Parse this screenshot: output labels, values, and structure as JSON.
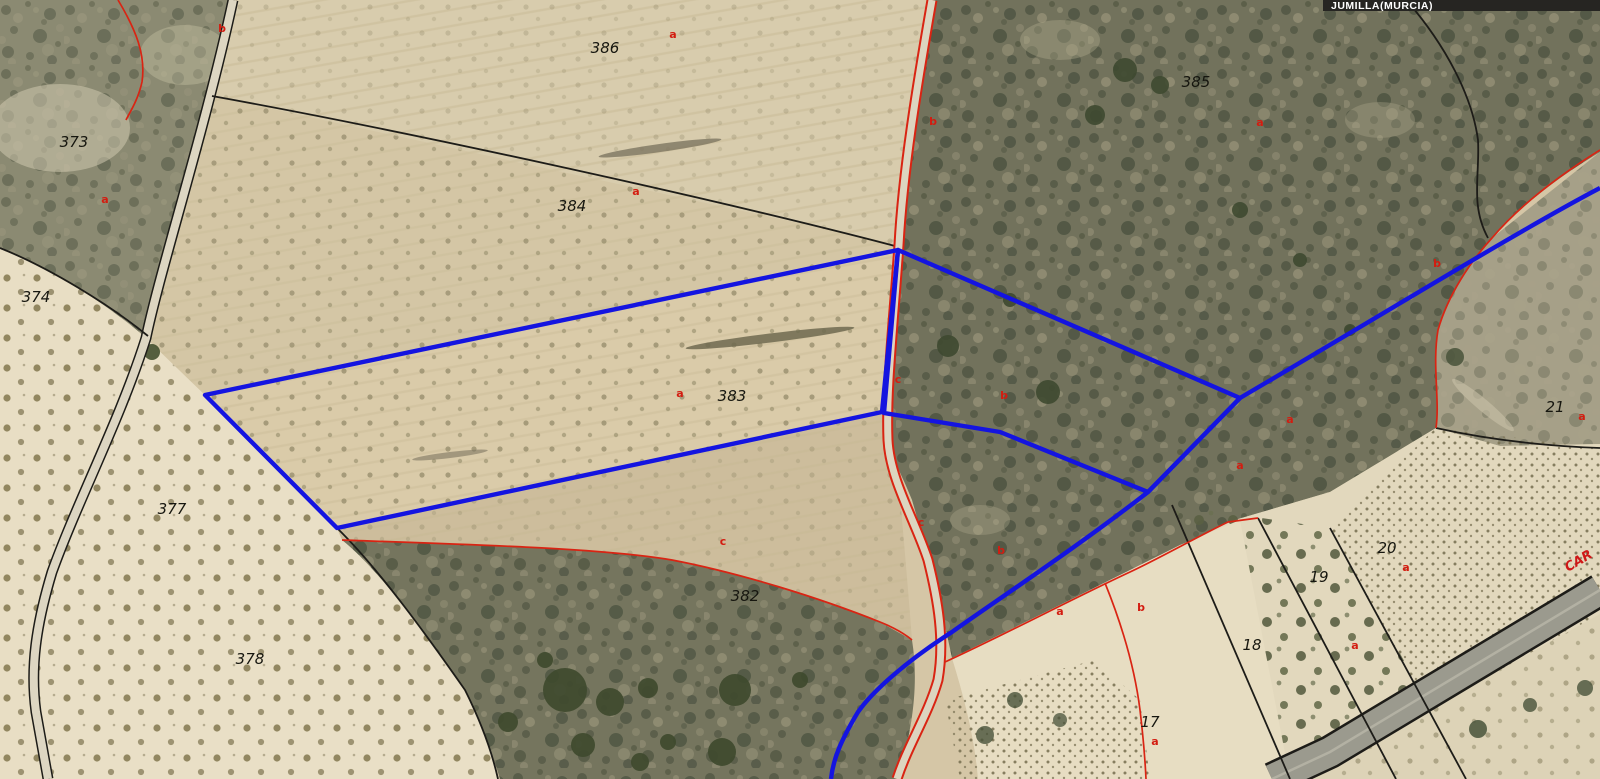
{
  "map": {
    "location_label": "JUMILLA(MURCIA)",
    "road_label": "CAR",
    "colors": {
      "highlight_blue": "#1414e0",
      "boundary_red": "#d92413",
      "boundary_black": "#1d1c18",
      "label_bar_bg": "#262522",
      "label_bar_text": "#ffffff"
    }
  },
  "parcels": [
    {
      "number": "386"
    },
    {
      "number": "373"
    },
    {
      "number": "374"
    },
    {
      "number": "384"
    },
    {
      "number": "385"
    },
    {
      "number": "383"
    },
    {
      "number": "377"
    },
    {
      "number": "382"
    },
    {
      "number": "378"
    },
    {
      "number": "21"
    },
    {
      "number": "20"
    },
    {
      "number": "19"
    },
    {
      "number": "18"
    },
    {
      "number": "17"
    }
  ],
  "subparcels": [
    {
      "letter": "b"
    },
    {
      "letter": "a"
    },
    {
      "letter": "a"
    },
    {
      "letter": "b"
    },
    {
      "letter": "a"
    },
    {
      "letter": "a"
    },
    {
      "letter": "b"
    },
    {
      "letter": "a"
    },
    {
      "letter": "c"
    },
    {
      "letter": "b"
    },
    {
      "letter": "a"
    },
    {
      "letter": "a"
    },
    {
      "letter": "c"
    },
    {
      "letter": "b"
    },
    {
      "letter": "c"
    },
    {
      "letter": "a"
    },
    {
      "letter": "b"
    },
    {
      "letter": "a"
    },
    {
      "letter": "a"
    },
    {
      "letter": "a"
    },
    {
      "letter": "a"
    }
  ]
}
